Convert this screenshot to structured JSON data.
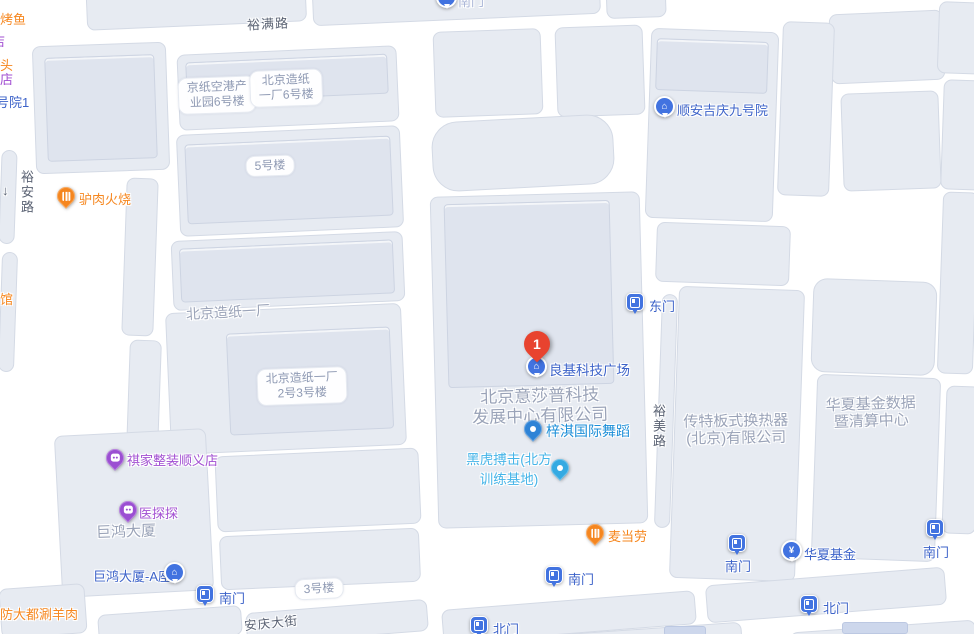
{
  "map": {
    "marker": {
      "number": "1",
      "title": "良基科技广场"
    },
    "roads": {
      "yuman": "裕满路",
      "yuan": "裕安路",
      "yumei": "裕美路",
      "anqing": "安庆大街",
      "arrow": "↓"
    },
    "pois": {
      "lvrou": "驴肉火烧",
      "mcdonalds": "麦当劳",
      "qijia": "祺家整装顺义店",
      "yitantan": "医探探",
      "ziqi": "梓淇国际舞蹈",
      "heihu_line1": "黑虎搏击(北方",
      "heihu_line2": "训练基地)",
      "liangji": "良基科技广场",
      "shunan": "顺安吉庆九号院",
      "juhong_a": "巨鸿大厦-A座",
      "huaxia_fund": "华夏基金"
    },
    "gates": {
      "east": "东门",
      "south": "南门",
      "north": "北门"
    },
    "pills": {
      "jingzhi_line1": "京纸空港产",
      "jingzhi_line2": "业园6号楼",
      "zaozhi6_line1": "北京造纸",
      "zaozhi6_line2": "一厂6号楼",
      "bldg5": "5号楼",
      "zaozhi23_line1": "北京造纸一厂",
      "zaozhi23_line2": "2号3号楼",
      "bldg3": "3号楼"
    },
    "areas": {
      "zaozhi": "北京造纸一厂",
      "yishapu_line1": "北京意莎普科技",
      "yishapu_line2": "发展中心有限公司",
      "juhong": "巨鸿大厦",
      "chuante_line1": "传特板式换热器",
      "chuante_line2": "(北京)有限公司",
      "huaxia_line1": "华夏基金数据",
      "huaxia_line2": "暨清算中心"
    },
    "edge": {
      "kaoyu": "烤鱼",
      "tou": "头",
      "dian": "店",
      "haoyuan1": "号院1",
      "guan": "馆",
      "shuanyangrou": "防大都涮羊肉"
    }
  },
  "colors": {
    "poi_blue_text": "#3d63c9",
    "poi_light_blue_text": "#45b4e8",
    "poi_mid_blue_text": "#1b8ed8",
    "poi_orange": "#f5861f",
    "poi_purple": "#9b4fd2",
    "gate_pin_blue": "#4273e0",
    "marker_red": "#e8432f",
    "area_gray_text": "#9aa3b8",
    "road_label_gray": "#5a6273",
    "block_fill": "#e7ebf2",
    "road_white": "#ffffff"
  }
}
